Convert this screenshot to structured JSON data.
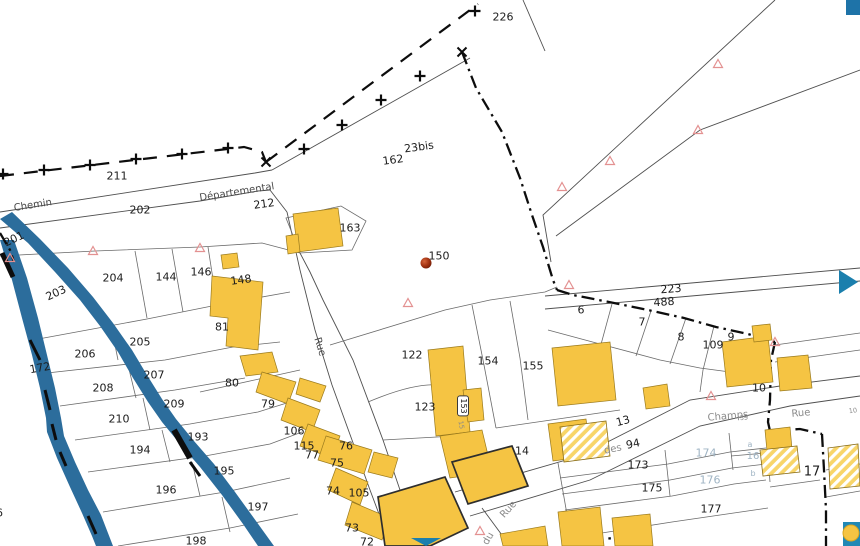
{
  "map": {
    "type": "cadastral-parcel-map",
    "colors": {
      "background": "#ffffff",
      "building": "#F5C443",
      "river": "#2C6D9C",
      "boundary": "#0d0d0d",
      "parcel_line": "#6a6a6a",
      "parcel_label": "#1c1c1c",
      "street_label_dark": "#4a4a4a",
      "street_label_gray": "#8a8a8a",
      "light_label": "#9FB4C4",
      "survey_triangle": "#E39191",
      "point_marker_red": "#8B2304",
      "ui_accent_teal": "#1B7FAD"
    },
    "labels": [
      {
        "t": "226",
        "x": 503,
        "y": 17
      },
      {
        "t": "211",
        "x": 117,
        "y": 176
      },
      {
        "t": "202",
        "x": 140,
        "y": 210
      },
      {
        "t": "212",
        "x": 264,
        "y": 204,
        "r": -8
      },
      {
        "t": "162",
        "x": 393,
        "y": 160,
        "r": -8
      },
      {
        "t": "23bis",
        "x": 419,
        "y": 147,
        "r": -8
      },
      {
        "t": "163",
        "x": 350,
        "y": 228
      },
      {
        "t": "201",
        "x": 14,
        "y": 239,
        "r": -25
      },
      {
        "t": "203",
        "x": 56,
        "y": 293,
        "r": -25
      },
      {
        "t": "204",
        "x": 113,
        "y": 278
      },
      {
        "t": "144",
        "x": 166,
        "y": 277
      },
      {
        "t": "146",
        "x": 201,
        "y": 272
      },
      {
        "t": "148",
        "x": 241,
        "y": 280,
        "r": -8
      },
      {
        "t": "81",
        "x": 222,
        "y": 327
      },
      {
        "t": "205",
        "x": 140,
        "y": 342
      },
      {
        "t": "206",
        "x": 85,
        "y": 354
      },
      {
        "t": "207",
        "x": 154,
        "y": 375
      },
      {
        "t": "208",
        "x": 103,
        "y": 388
      },
      {
        "t": "209",
        "x": 174,
        "y": 404
      },
      {
        "t": "210",
        "x": 119,
        "y": 419
      },
      {
        "t": "172",
        "x": 40,
        "y": 368,
        "r": -10
      },
      {
        "t": "193",
        "x": 198,
        "y": 437
      },
      {
        "t": "194",
        "x": 140,
        "y": 450
      },
      {
        "t": "195",
        "x": 224,
        "y": 471
      },
      {
        "t": "196",
        "x": 166,
        "y": 490
      },
      {
        "t": "197",
        "x": 258,
        "y": 507
      },
      {
        "t": "198",
        "x": 196,
        "y": 541
      },
      {
        "t": "66",
        "x": -4,
        "y": 513
      },
      {
        "t": "80",
        "x": 232,
        "y": 383
      },
      {
        "t": "79",
        "x": 268,
        "y": 404
      },
      {
        "t": "122",
        "x": 412,
        "y": 355
      },
      {
        "t": "123",
        "x": 425,
        "y": 407
      },
      {
        "t": "106",
        "x": 294,
        "y": 431
      },
      {
        "t": "115",
        "x": 304,
        "y": 446
      },
      {
        "t": "77",
        "x": 312,
        "y": 455
      },
      {
        "t": "76",
        "x": 346,
        "y": 446
      },
      {
        "t": "75",
        "x": 337,
        "y": 463
      },
      {
        "t": "74",
        "x": 333,
        "y": 491
      },
      {
        "t": "105",
        "x": 359,
        "y": 493
      },
      {
        "t": "73",
        "x": 352,
        "y": 528
      },
      {
        "t": "72",
        "x": 367,
        "y": 542
      },
      {
        "t": "154",
        "x": 488,
        "y": 361
      },
      {
        "t": "155",
        "x": 533,
        "y": 366
      },
      {
        "t": "14",
        "x": 522,
        "y": 451
      },
      {
        "t": "6",
        "x": 581,
        "y": 310
      },
      {
        "t": "7",
        "x": 642,
        "y": 322
      },
      {
        "t": "8",
        "x": 681,
        "y": 337
      },
      {
        "t": "109",
        "x": 713,
        "y": 345
      },
      {
        "t": "9",
        "x": 731,
        "y": 337
      },
      {
        "t": "10",
        "x": 759,
        "y": 388
      },
      {
        "t": "223",
        "x": 671,
        "y": 289,
        "r": -4
      },
      {
        "t": "488",
        "x": 664,
        "y": 302,
        "r": -4
      },
      {
        "t": "13",
        "x": 623,
        "y": 421,
        "r": -15
      },
      {
        "t": "94",
        "x": 633,
        "y": 444,
        "r": -12
      },
      {
        "t": "173",
        "x": 638,
        "y": 465
      },
      {
        "t": "174",
        "x": 706,
        "y": 453,
        "c": "light"
      },
      {
        "t": "175",
        "x": 652,
        "y": 488
      },
      {
        "t": "176",
        "x": 710,
        "y": 480,
        "c": "light"
      },
      {
        "t": "177",
        "x": 711,
        "y": 509
      },
      {
        "t": "a",
        "x": 750,
        "y": 445,
        "c": "light",
        "s": 8
      },
      {
        "t": "16",
        "x": 753,
        "y": 457,
        "c": "light",
        "s": 10
      },
      {
        "t": "b",
        "x": 753,
        "y": 474,
        "c": "light",
        "s": 8
      },
      {
        "t": "17",
        "x": 812,
        "y": 472,
        "s": 13
      },
      {
        "t": "150",
        "x": 439,
        "y": 256
      }
    ],
    "boxed_labels": [
      {
        "t": "153",
        "x": 463,
        "y": 406,
        "r": 90,
        "s": 8
      }
    ],
    "tiny_labels": [
      {
        "t": "35",
        "x": 744,
        "y": 418,
        "r": -5
      },
      {
        "t": "10",
        "x": 853,
        "y": 411,
        "r": -8
      },
      {
        "t": "15",
        "x": 461,
        "y": 425,
        "r": 80
      }
    ],
    "street_labels": [
      {
        "t": "Chemin",
        "x": 33,
        "y": 206,
        "r": -9,
        "c": "dark"
      },
      {
        "t": "Départemental",
        "x": 237,
        "y": 193,
        "r": -9,
        "c": "dark"
      },
      {
        "t": "Rue",
        "x": 319,
        "y": 347,
        "r": 73,
        "c": "dark"
      },
      {
        "t": "Rue",
        "x": 509,
        "y": 510,
        "r": -48,
        "c": "gray"
      },
      {
        "t": "du",
        "x": 489,
        "y": 539,
        "r": -60,
        "c": "gray"
      },
      {
        "t": "des",
        "x": 613,
        "y": 450,
        "r": -12,
        "c": "gray"
      },
      {
        "t": "Champs",
        "x": 728,
        "y": 417,
        "r": -5,
        "c": "gray"
      },
      {
        "t": "Rue",
        "x": 801,
        "y": 414,
        "r": -5,
        "c": "gray"
      }
    ],
    "markers": {
      "survey_triangles": [
        [
          10,
          258
        ],
        [
          93,
          251
        ],
        [
          200,
          248
        ],
        [
          408,
          303
        ],
        [
          562,
          187
        ],
        [
          610,
          161
        ],
        [
          718,
          64
        ],
        [
          698,
          130
        ],
        [
          569,
          285
        ],
        [
          775,
          342
        ],
        [
          711,
          396
        ],
        [
          480,
          531
        ]
      ],
      "boundary_plus_crosses": [
        [
          3,
          174
        ],
        [
          44,
          170
        ],
        [
          90,
          165
        ],
        [
          136,
          159
        ],
        [
          182,
          154
        ],
        [
          228,
          148
        ],
        [
          304,
          149
        ],
        [
          342,
          125
        ],
        [
          381,
          100
        ],
        [
          420,
          76
        ],
        [
          475,
          11
        ]
      ],
      "boundary_x_crosses": [
        [
          266,
          162
        ],
        [
          462,
          52
        ]
      ],
      "red_point": {
        "label": "150",
        "x": 426,
        "y": 263
      }
    }
  }
}
